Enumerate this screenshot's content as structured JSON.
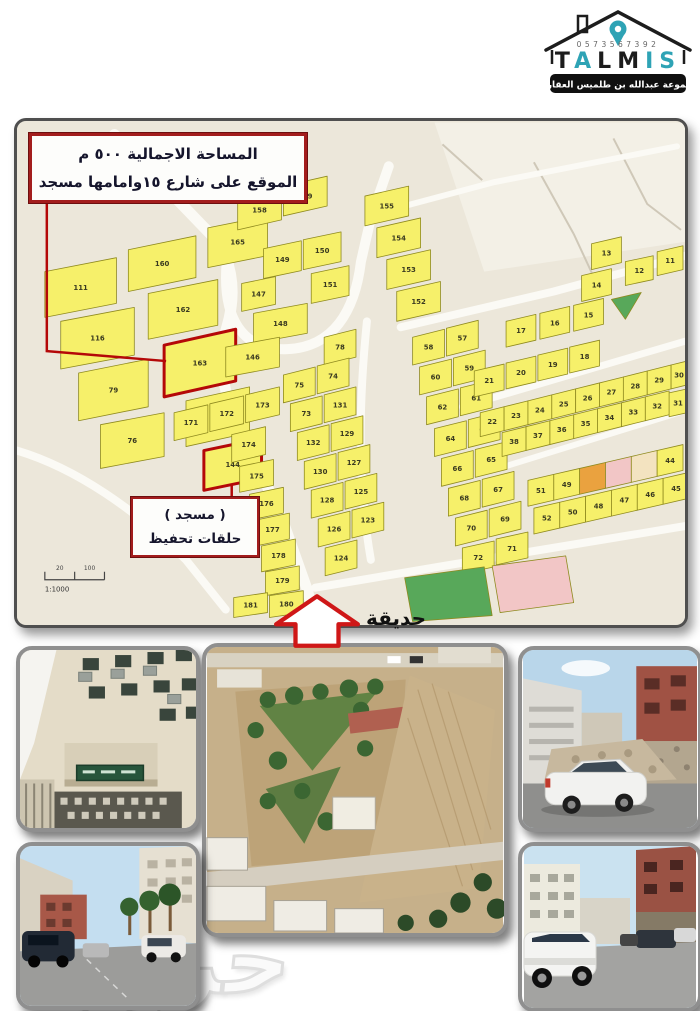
{
  "logo": {
    "phone": "0573567392",
    "brand": "TALMIS",
    "letters": [
      {
        "ch": "T",
        "color": "#1c1c1c"
      },
      {
        "ch": "A",
        "color": "#2ea3b5"
      },
      {
        "ch": "L",
        "color": "#1c1c1c"
      },
      {
        "ch": "M",
        "color": "#1c1c1c"
      },
      {
        "ch": "I",
        "color": "#2ea3b5"
      },
      {
        "ch": "S",
        "color": "#2ea3b5"
      }
    ],
    "subtitle": "مجموعة عبدالله بن طلميس العقارية"
  },
  "map": {
    "annotation_box": {
      "line1": "المساحة الاجمالية  ٥٠٠ م",
      "line2": "الموقع على شارع ١٥وامامها مسجد"
    },
    "mosque_box": {
      "line1": "( مسجد )",
      "line2": "حلقات تحفيظ"
    },
    "park_label": "حديقة",
    "scale": {
      "tick1": "20",
      "tick2": "100",
      "ratio": "1:1000"
    },
    "colors": {
      "bg": "#ece7da",
      "region_light": "#f3f0e6",
      "street": "#fbfaf5",
      "thin_road": "#cfc8b8",
      "plot_yellow": "#f6f06a",
      "plot_green": "#58a85a",
      "plot_pink": "#f2c6c6",
      "plot_orange": "#eaa23f",
      "plot_cream": "#f3e3c0",
      "plot_border": "#8f8a1f",
      "plot_number": "#3a3a20",
      "highlight": "#b40808"
    },
    "region_light": "420,0 672,0 672,120 470,150",
    "streets": [
      {
        "d": "M 98,12 L 204,122 C 218,148 220,176 211,206 C 200,242 208,284 236,330 L 270,408 L 292,470 L 300,502",
        "w": 11
      },
      {
        "d": "M 211,140 C 206,196 226,230 272,228 C 318,226 340,190 346,140 L 356,96 L 374,44",
        "w": 10
      },
      {
        "d": "M 360,92 L 480,60 L 664,24",
        "w": 6
      },
      {
        "d": "M 386,206 L 540,170 L 672,134",
        "w": 8
      },
      {
        "d": "M 478,350 L 672,290",
        "w": 6
      },
      {
        "d": "M 300,468 L 430,446 L 672,406",
        "w": 8
      },
      {
        "d": "M 352,200 C 344,280 342,360 356,440",
        "w": 8
      },
      {
        "d": "M 448,286 L 672,220",
        "w": 7
      },
      {
        "d": "M 0,330 C 60,348 120,390 170,440 L 210,490",
        "w": 8
      }
    ],
    "thin_roads": [
      "M 520,40 L 560,112",
      "M 600,16 L 634,82 L 668,108",
      "M 428,22 L 468,58",
      "M 560,112 L 586,168"
    ],
    "red_lines": [
      "M 30,78 L 30,230 L 150,240",
      "M 216,364 L 216,376"
    ],
    "plots": [
      {
        "n": "111",
        "x": 28,
        "y": 150,
        "w": 72,
        "h": 46,
        "s": 14
      },
      {
        "n": "160",
        "x": 112,
        "y": 128,
        "w": 68,
        "h": 42,
        "s": 14
      },
      {
        "n": "165",
        "x": 192,
        "y": 106,
        "w": 60,
        "h": 40,
        "s": 12
      },
      {
        "n": "116",
        "x": 44,
        "y": 200,
        "w": 74,
        "h": 48,
        "s": 14
      },
      {
        "n": "162",
        "x": 132,
        "y": 172,
        "w": 70,
        "h": 46,
        "s": 14
      },
      {
        "n": "79",
        "x": 62,
        "y": 252,
        "w": 70,
        "h": 48,
        "s": 14
      },
      {
        "n": "163",
        "x": 148,
        "y": 224,
        "w": 72,
        "h": 52,
        "s": 16,
        "f": "hl"
      },
      {
        "n": "76",
        "x": 84,
        "y": 304,
        "w": 64,
        "h": 44,
        "s": 12
      },
      {
        "n": "164",
        "x": 170,
        "y": 280,
        "w": 64,
        "h": 46,
        "s": 14
      },
      {
        "n": "144",
        "x": 188,
        "y": 330,
        "w": 58,
        "h": 40,
        "s": 12,
        "f": "hl"
      },
      {
        "n": "158",
        "x": 222,
        "y": 78,
        "w": 44,
        "h": 30,
        "s": 10
      },
      {
        "n": "159",
        "x": 268,
        "y": 64,
        "w": 44,
        "h": 30,
        "s": 10
      },
      {
        "n": "149",
        "x": 248,
        "y": 127,
        "w": 38,
        "h": 30,
        "s": 8
      },
      {
        "n": "150",
        "x": 288,
        "y": 118,
        "w": 38,
        "h": 30,
        "s": 8
      },
      {
        "n": "147",
        "x": 226,
        "y": 162,
        "w": 34,
        "h": 28,
        "s": 7
      },
      {
        "n": "151",
        "x": 296,
        "y": 152,
        "w": 38,
        "h": 30,
        "s": 8
      },
      {
        "n": "148",
        "x": 238,
        "y": 192,
        "w": 54,
        "h": 30,
        "s": 10
      },
      {
        "n": "146",
        "x": 210,
        "y": 226,
        "w": 54,
        "h": 30,
        "s": 10
      },
      {
        "n": "155",
        "x": 350,
        "y": 74,
        "w": 44,
        "h": 30,
        "s": 10
      },
      {
        "n": "154",
        "x": 362,
        "y": 106,
        "w": 44,
        "h": 30,
        "s": 10
      },
      {
        "n": "153",
        "x": 372,
        "y": 138,
        "w": 44,
        "h": 30,
        "s": 10
      },
      {
        "n": "152",
        "x": 382,
        "y": 170,
        "w": 44,
        "h": 30,
        "s": 10
      },
      {
        "n": "78",
        "x": 309,
        "y": 216
      },
      {
        "n": "74",
        "x": 302,
        "y": 245
      },
      {
        "n": "75",
        "x": 268,
        "y": 254
      },
      {
        "n": "131",
        "x": 309,
        "y": 274
      },
      {
        "n": "73",
        "x": 275,
        "y": 283
      },
      {
        "n": "129",
        "x": 316,
        "y": 303
      },
      {
        "n": "132",
        "x": 282,
        "y": 312
      },
      {
        "n": "127",
        "x": 323,
        "y": 332
      },
      {
        "n": "130",
        "x": 289,
        "y": 341
      },
      {
        "n": "125",
        "x": 330,
        "y": 361
      },
      {
        "n": "128",
        "x": 296,
        "y": 370
      },
      {
        "n": "123",
        "x": 337,
        "y": 390
      },
      {
        "n": "126",
        "x": 303,
        "y": 399
      },
      {
        "n": "124",
        "x": 310,
        "y": 428
      },
      {
        "n": "171",
        "x": 158,
        "y": 292,
        "w": 34,
        "h": 28
      },
      {
        "n": "172",
        "x": 194,
        "y": 283,
        "w": 34,
        "h": 28
      },
      {
        "n": "173",
        "x": 230,
        "y": 274,
        "w": 34,
        "h": 28
      },
      {
        "n": "174",
        "x": 216,
        "y": 314,
        "w": 34,
        "h": 28
      },
      {
        "n": "175",
        "x": 224,
        "y": 346,
        "w": 34,
        "h": 26,
        "s": 7
      },
      {
        "n": "176",
        "x": 234,
        "y": 374,
        "w": 34,
        "h": 26,
        "s": 7
      },
      {
        "n": "177",
        "x": 240,
        "y": 400,
        "w": 34,
        "h": 26,
        "s": 7
      },
      {
        "n": "178",
        "x": 246,
        "y": 426,
        "w": 34,
        "h": 26,
        "s": 7
      },
      {
        "n": "179",
        "x": 250,
        "y": 452,
        "w": 34,
        "h": 24,
        "s": 6
      },
      {
        "n": "180",
        "x": 254,
        "y": 476,
        "w": 34,
        "h": 22,
        "s": 5
      },
      {
        "n": "181",
        "x": 218,
        "y": 478,
        "w": 34,
        "h": 20,
        "s": 5
      },
      {
        "n": "57",
        "x": 432,
        "y": 207
      },
      {
        "n": "58",
        "x": 398,
        "y": 216
      },
      {
        "n": "59",
        "x": 439,
        "y": 237
      },
      {
        "n": "60",
        "x": 405,
        "y": 246
      },
      {
        "n": "61",
        "x": 446,
        "y": 267
      },
      {
        "n": "62",
        "x": 412,
        "y": 276
      },
      {
        "n": "63",
        "x": 454,
        "y": 299
      },
      {
        "n": "64",
        "x": 420,
        "y": 308
      },
      {
        "n": "65",
        "x": 461,
        "y": 329
      },
      {
        "n": "66",
        "x": 427,
        "y": 338
      },
      {
        "n": "67",
        "x": 468,
        "y": 359
      },
      {
        "n": "68",
        "x": 434,
        "y": 368
      },
      {
        "n": "69",
        "x": 475,
        "y": 389
      },
      {
        "n": "70",
        "x": 441,
        "y": 398
      },
      {
        "n": "71",
        "x": 482,
        "y": 419,
        "w": 32,
        "h": 26,
        "s": 7
      },
      {
        "n": "72",
        "x": 448,
        "y": 428,
        "w": 32,
        "h": 26,
        "s": 7
      },
      {
        "n": "13",
        "x": 578,
        "y": 122,
        "w": 30,
        "h": 26,
        "s": 7
      },
      {
        "n": "12",
        "x": 612,
        "y": 140,
        "w": 28,
        "h": 24,
        "s": 6
      },
      {
        "n": "11",
        "x": 644,
        "y": 130,
        "w": 26,
        "h": 24,
        "s": 6
      },
      {
        "n": "14",
        "x": 568,
        "y": 154,
        "w": 30,
        "h": 26,
        "s": 7
      },
      {
        "n": "15",
        "x": 560,
        "y": 184,
        "w": 30,
        "h": 26,
        "s": 7
      },
      {
        "n": "",
        "pts": [
          [
            598,
            178
          ],
          [
            628,
            171
          ],
          [
            612,
            198
          ]
        ],
        "f": "g"
      },
      {
        "n": "16",
        "x": 526,
        "y": 192,
        "w": 30,
        "h": 26,
        "s": 7
      },
      {
        "n": "17",
        "x": 492,
        "y": 200,
        "w": 30,
        "h": 26,
        "s": 7
      },
      {
        "n": "18",
        "x": 556,
        "y": 226,
        "w": 30,
        "h": 26,
        "s": 7
      },
      {
        "n": "19",
        "x": 524,
        "y": 234,
        "w": 30,
        "h": 26,
        "s": 7
      },
      {
        "n": "20",
        "x": 492,
        "y": 242,
        "w": 30,
        "h": 26,
        "s": 7
      },
      {
        "n": "21",
        "x": 460,
        "y": 250,
        "w": 30,
        "h": 26,
        "s": 7
      },
      {
        "n": "22",
        "x": 466,
        "y": 292,
        "w": 24,
        "h": 24,
        "s": 6
      },
      {
        "n": "23",
        "x": 490,
        "y": 286,
        "w": 24,
        "h": 24,
        "s": 6
      },
      {
        "n": "24",
        "x": 514,
        "y": 280,
        "w": 24,
        "h": 24,
        "s": 6
      },
      {
        "n": "25",
        "x": 538,
        "y": 274,
        "w": 24,
        "h": 24,
        "s": 6
      },
      {
        "n": "26",
        "x": 562,
        "y": 268,
        "w": 24,
        "h": 24,
        "s": 6
      },
      {
        "n": "27",
        "x": 586,
        "y": 262,
        "w": 24,
        "h": 24,
        "s": 6
      },
      {
        "n": "28",
        "x": 610,
        "y": 256,
        "w": 24,
        "h": 24,
        "s": 6
      },
      {
        "n": "29",
        "x": 634,
        "y": 250,
        "w": 24,
        "h": 24,
        "s": 6
      },
      {
        "n": "30",
        "x": 658,
        "y": 244,
        "w": 16,
        "h": 24,
        "s": 4
      },
      {
        "n": "31",
        "x": 656,
        "y": 272,
        "w": 18,
        "h": 24,
        "s": 4
      },
      {
        "n": "32",
        "x": 632,
        "y": 276,
        "w": 24,
        "h": 24,
        "s": 6
      },
      {
        "n": "33",
        "x": 608,
        "y": 282,
        "w": 24,
        "h": 24,
        "s": 6
      },
      {
        "n": "34",
        "x": 584,
        "y": 288,
        "w": 24,
        "h": 24,
        "s": 6
      },
      {
        "n": "35",
        "x": 560,
        "y": 294,
        "w": 24,
        "h": 24,
        "s": 6
      },
      {
        "n": "36",
        "x": 536,
        "y": 300,
        "w": 24,
        "h": 24,
        "s": 6
      },
      {
        "n": "37",
        "x": 512,
        "y": 306,
        "w": 24,
        "h": 24,
        "s": 6
      },
      {
        "n": "38",
        "x": 488,
        "y": 312,
        "w": 24,
        "h": 24,
        "s": 6
      },
      {
        "n": "51",
        "x": 514,
        "y": 360,
        "w": 26,
        "h": 26,
        "s": 6
      },
      {
        "n": "49",
        "x": 540,
        "y": 354,
        "w": 26,
        "h": 26,
        "s": 6
      },
      {
        "n": "",
        "x": 566,
        "y": 348,
        "w": 26,
        "h": 26,
        "s": 6,
        "f": "o"
      },
      {
        "n": "",
        "x": 592,
        "y": 342,
        "w": 26,
        "h": 26,
        "s": 6,
        "f": "p"
      },
      {
        "n": "",
        "x": 618,
        "y": 336,
        "w": 26,
        "h": 26,
        "s": 6,
        "f": "c"
      },
      {
        "n": "44",
        "x": 644,
        "y": 330,
        "w": 26,
        "h": 26,
        "s": 6
      },
      {
        "n": "52",
        "x": 520,
        "y": 388,
        "w": 26,
        "h": 26,
        "s": 6
      },
      {
        "n": "50",
        "x": 546,
        "y": 382,
        "w": 26,
        "h": 26,
        "s": 6
      },
      {
        "n": "48",
        "x": 572,
        "y": 376,
        "w": 26,
        "h": 26,
        "s": 6
      },
      {
        "n": "47",
        "x": 598,
        "y": 370,
        "w": 26,
        "h": 26,
        "s": 6
      },
      {
        "n": "46",
        "x": 624,
        "y": 364,
        "w": 26,
        "h": 26,
        "s": 6
      },
      {
        "n": "45",
        "x": 650,
        "y": 358,
        "w": 26,
        "h": 26,
        "s": 6
      },
      {
        "n": "",
        "pts": [
          [
            390,
            458
          ],
          [
            470,
            447
          ],
          [
            478,
            496
          ],
          [
            398,
            502
          ]
        ],
        "f": "g"
      },
      {
        "n": "",
        "pts": [
          [
            478,
            446
          ],
          [
            552,
            436
          ],
          [
            560,
            483
          ],
          [
            486,
            493
          ]
        ],
        "f": "p"
      }
    ]
  },
  "watermark": "حراج"
}
